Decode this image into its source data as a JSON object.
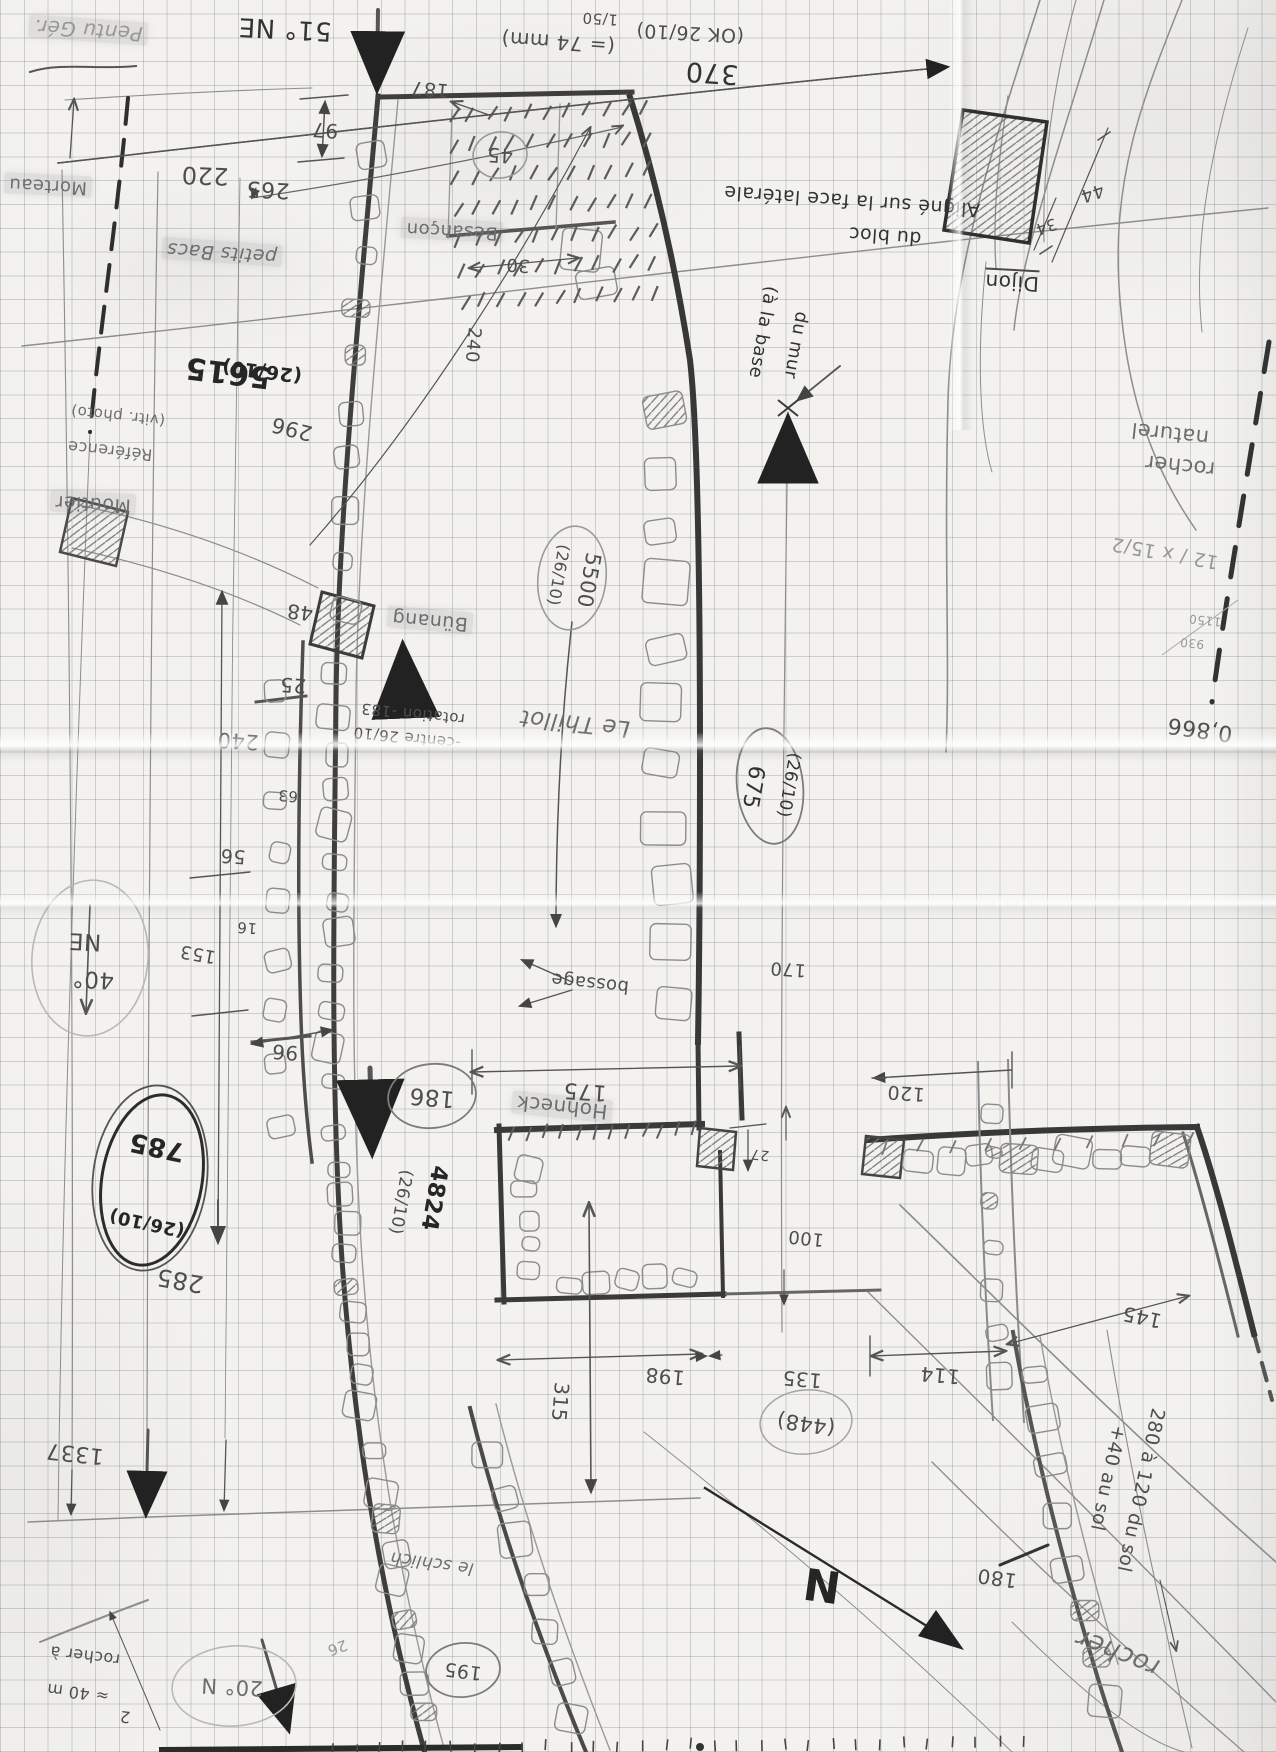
{
  "sketch": {
    "labels": {
      "pentu_ger": {
        "text": "Pentu Gér."
      },
      "morteau": {
        "text": "Morteau"
      },
      "d220": {
        "text": "220"
      },
      "b51ne": {
        "text": "51° NE"
      },
      "d97": {
        "text": "97"
      },
      "d265": {
        "text": "265"
      },
      "d187": {
        "text": "187"
      },
      "s74": {
        "text": "(= 74 mm)"
      },
      "s150": {
        "text": "1/50"
      },
      "ok2610": {
        "text": "(OK 26/10)"
      },
      "d370": {
        "text": "370"
      },
      "petits_bacs": {
        "text": "petits Bacs"
      },
      "besancon": {
        "text": "Besançon"
      },
      "d45": {
        "text": "45"
      },
      "d30": {
        "text": "30"
      },
      "d240v": {
        "text": "240"
      },
      "aligne1": {
        "text": "Aligné sur la face latérale"
      },
      "aligne2": {
        "text": "du bloc"
      },
      "dijon": {
        "text": "Dijon"
      },
      "d34": {
        "text": "34"
      },
      "d44": {
        "text": "44"
      },
      "base1": {
        "text": "(à la base"
      },
      "base2": {
        "text": "du mur"
      },
      "r5615": {
        "text": "5615"
      },
      "r5615b": {
        "text": "(26/10)"
      },
      "d296": {
        "text": "296"
      },
      "ref1": {
        "text": "Référence"
      },
      "ref2": {
        "text": "(vitr. photo)"
      },
      "moutier": {
        "text": "Moutier"
      },
      "d48": {
        "text": "48"
      },
      "d25": {
        "text": "25"
      },
      "r5500": {
        "text": "5500"
      },
      "r5500b": {
        "text": "(26/10)"
      },
      "bunang": {
        "text": "Bünang"
      },
      "centre2610": {
        "text": "-centre 26/10"
      },
      "rot183": {
        "text": "rotation -183"
      },
      "thillot": {
        "text": "Le Thillot"
      },
      "r675": {
        "text": "675"
      },
      "r675b": {
        "text": "(26/10)"
      },
      "d63": {
        "text": "63"
      },
      "d240": {
        "text": "240"
      },
      "d56": {
        "text": "56"
      },
      "d16": {
        "text": "16"
      },
      "d153": {
        "text": "153"
      },
      "d96": {
        "text": "96"
      },
      "b40": {
        "text": "40°"
      },
      "b40b": {
        "text": "NE"
      },
      "r785": {
        "text": "785"
      },
      "r785b": {
        "text": "(26/10)"
      },
      "d285": {
        "text": "285"
      },
      "d1337": {
        "text": "1337"
      },
      "c186": {
        "text": "186"
      },
      "d175": {
        "text": "175"
      },
      "bossage": {
        "text": "bossage"
      },
      "r4824": {
        "text": "4824"
      },
      "r4824b": {
        "text": "(26/10)"
      },
      "hohneck": {
        "text": "Hohneck"
      },
      "d100": {
        "text": "100"
      },
      "d27": {
        "text": "27"
      },
      "d170": {
        "text": "170"
      },
      "d120": {
        "text": "120"
      },
      "d145": {
        "text": "145"
      },
      "d198": {
        "text": "198"
      },
      "d135": {
        "text": "135"
      },
      "d114": {
        "text": "114"
      },
      "c448": {
        "text": "(448)"
      },
      "d315": {
        "text": "315"
      },
      "c195": {
        "text": "195"
      },
      "schlich": {
        "text": "le schlich"
      },
      "b20n": {
        "text": "20° N"
      },
      "rocher40a": {
        "text": "rocher à"
      },
      "rocher40b": {
        "text": "≈ 40 m"
      },
      "n2": {
        "text": "2"
      },
      "d26f": {
        "text": "26"
      },
      "compass_n": {
        "text": "N"
      },
      "rocher_br": {
        "text": "rocher"
      },
      "rnat1": {
        "text": "rocher"
      },
      "rnat2": {
        "text": "naturel"
      },
      "ratio": {
        "text": "12 / x 15/2"
      },
      "f1150": {
        "text": "1150"
      },
      "f930": {
        "text": "930"
      },
      "n0866": {
        "text": "0,866"
      },
      "d180": {
        "text": "180"
      },
      "sol280": {
        "text": "280 à 120 du sol"
      },
      "sol40": {
        "text": "+40 au sol"
      }
    }
  }
}
